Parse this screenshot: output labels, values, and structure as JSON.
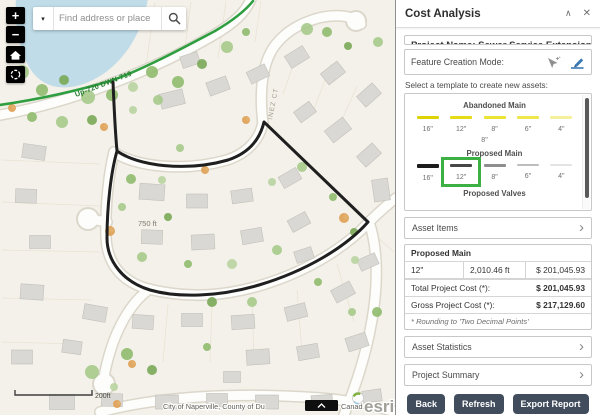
{
  "map": {
    "search": {
      "placeholder": "Find address or place",
      "dropdown": "▾"
    },
    "labels": {
      "utility_line": "Up-720 DWN-719",
      "distance": "750 ft",
      "street": "INEZ CT",
      "scale": "200ft",
      "attribution_left": "City of Naperville, County of Du",
      "attribution_right": "Canad...",
      "esri": "esri"
    },
    "controls": {
      "zoom_in": "+",
      "zoom_out": "−"
    }
  },
  "panel": {
    "title": "Cost Analysis",
    "header_icons": {
      "collapse": "∧",
      "close": "✕"
    },
    "project_name": "Project Name: Sewer Service Extension",
    "feature_creation_label": "Feature Creation Mode:",
    "template_instruction": "Select a template to create new assets:",
    "stray_label": "8\"",
    "selection_color": "#3cb043",
    "accordion_chevron": "›",
    "template_groups": [
      {
        "name": "Abandoned Main",
        "items": [
          {
            "label": "16\"",
            "color": "#ded303",
            "weight": 3
          },
          {
            "label": "12\"",
            "color": "#e4dc14",
            "weight": 3
          },
          {
            "label": "8\"",
            "color": "#eae432",
            "weight": 3
          },
          {
            "label": "6\"",
            "color": "#eee84e",
            "weight": 3
          },
          {
            "label": "4\"",
            "color": "#f4f09b",
            "weight": 3
          }
        ]
      },
      {
        "name": "Proposed Main",
        "items": [
          {
            "label": "16\"",
            "color": "#1c1c1c",
            "weight": 4
          },
          {
            "label": "12\"",
            "color": "#474747",
            "weight": 3,
            "selected": true
          },
          {
            "label": "8\"",
            "color": "#8e8e8e",
            "weight": 3
          },
          {
            "label": "6\"",
            "color": "#bdbdbd",
            "weight": 2
          },
          {
            "label": "4\"",
            "color": "#e3e3e3",
            "weight": 2
          }
        ]
      },
      {
        "name": "Proposed Valves",
        "items": []
      }
    ],
    "accordions": [
      "Asset Items",
      "Asset Statistics",
      "Project Summary"
    ],
    "cost_table": {
      "group_header": "Proposed Main",
      "rows": [
        [
          "12\"",
          "2,010.46 ft",
          "$ 201,045.93"
        ]
      ],
      "total_label": "Total Project Cost (*):",
      "total_value": "$ 201,045.93",
      "gross_label": "Gross Project Cost (*):",
      "gross_value": "$ 217,129.60",
      "note": "* Rounding to 'Two Decimal Points'"
    },
    "buttons": [
      "Back",
      "Refresh",
      "Export Report"
    ]
  }
}
